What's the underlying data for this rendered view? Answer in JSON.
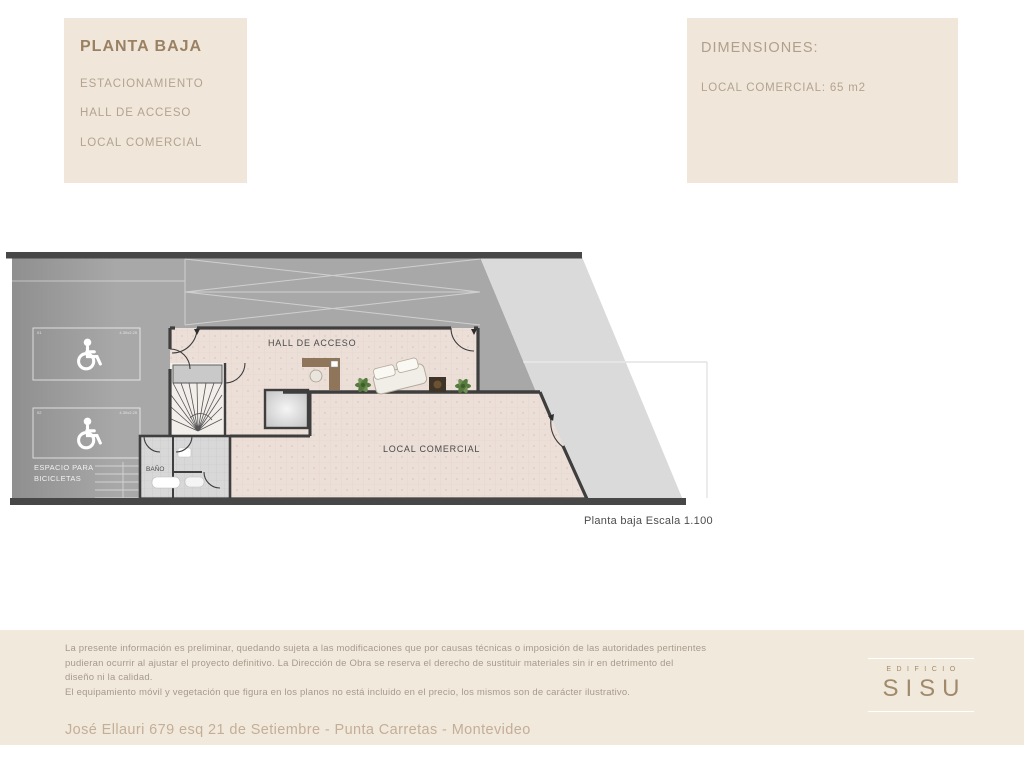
{
  "header": {
    "plan_box": {
      "title": "PLANTA BAJA",
      "items": [
        "ESTACIONAMIENTO",
        "HALL DE ACCESO",
        "LOCAL COMERCIAL"
      ]
    },
    "dimensions_box": {
      "title": "DIMENSIONES:",
      "local_line": "LOCAL COMERCIAL: 65 m2"
    }
  },
  "plan": {
    "labels": {
      "hall": "HALL DE ACCESO",
      "local": "LOCAL COMERCIAL",
      "bano": "BAÑO",
      "bikes_line1": "ESPACIO PARA",
      "bikes_line2": "BICICLETAS",
      "stall1_num": "01",
      "stall2_num": "02",
      "stall1_dim": "4.30x2.25",
      "stall2_dim": "4.30x2.25"
    },
    "caption": "Planta baja Escala 1.100"
  },
  "footer": {
    "disclaimer_lines": [
      "La presente información es preliminar, quedando sujeta a las modificaciones que por causas técnicas o imposición de las autoridades pertinentes",
      "pudieran ocurrir al ajustar el proyecto definitivo. La Dirección de Obra se reserva el derecho de sustituir materiales sin ir en detrimento del",
      "diseño ni la calidad.",
      "El equipamiento móvil y vegetación que figura en los planos no está incluido en el precio, los mismos son de carácter ilustrativo."
    ],
    "address": "José Ellauri 679 esq 21 de Setiembre - Punta Carretas - Montevideo",
    "logo": {
      "top": "EDIFICIO",
      "name": "SISU"
    }
  },
  "colors": {
    "panel_beige": "#f0e7da",
    "footer_beige": "#f2e9dd",
    "title_brown": "#9b8164",
    "body_brown": "#b3a390",
    "logo_brown": "#a18a6c",
    "garage_gray": "#a8a8a8",
    "sidewalk_gray": "#dadada",
    "floor_pink": "#ecdfd8",
    "wall_dark": "#3e3e3e"
  }
}
